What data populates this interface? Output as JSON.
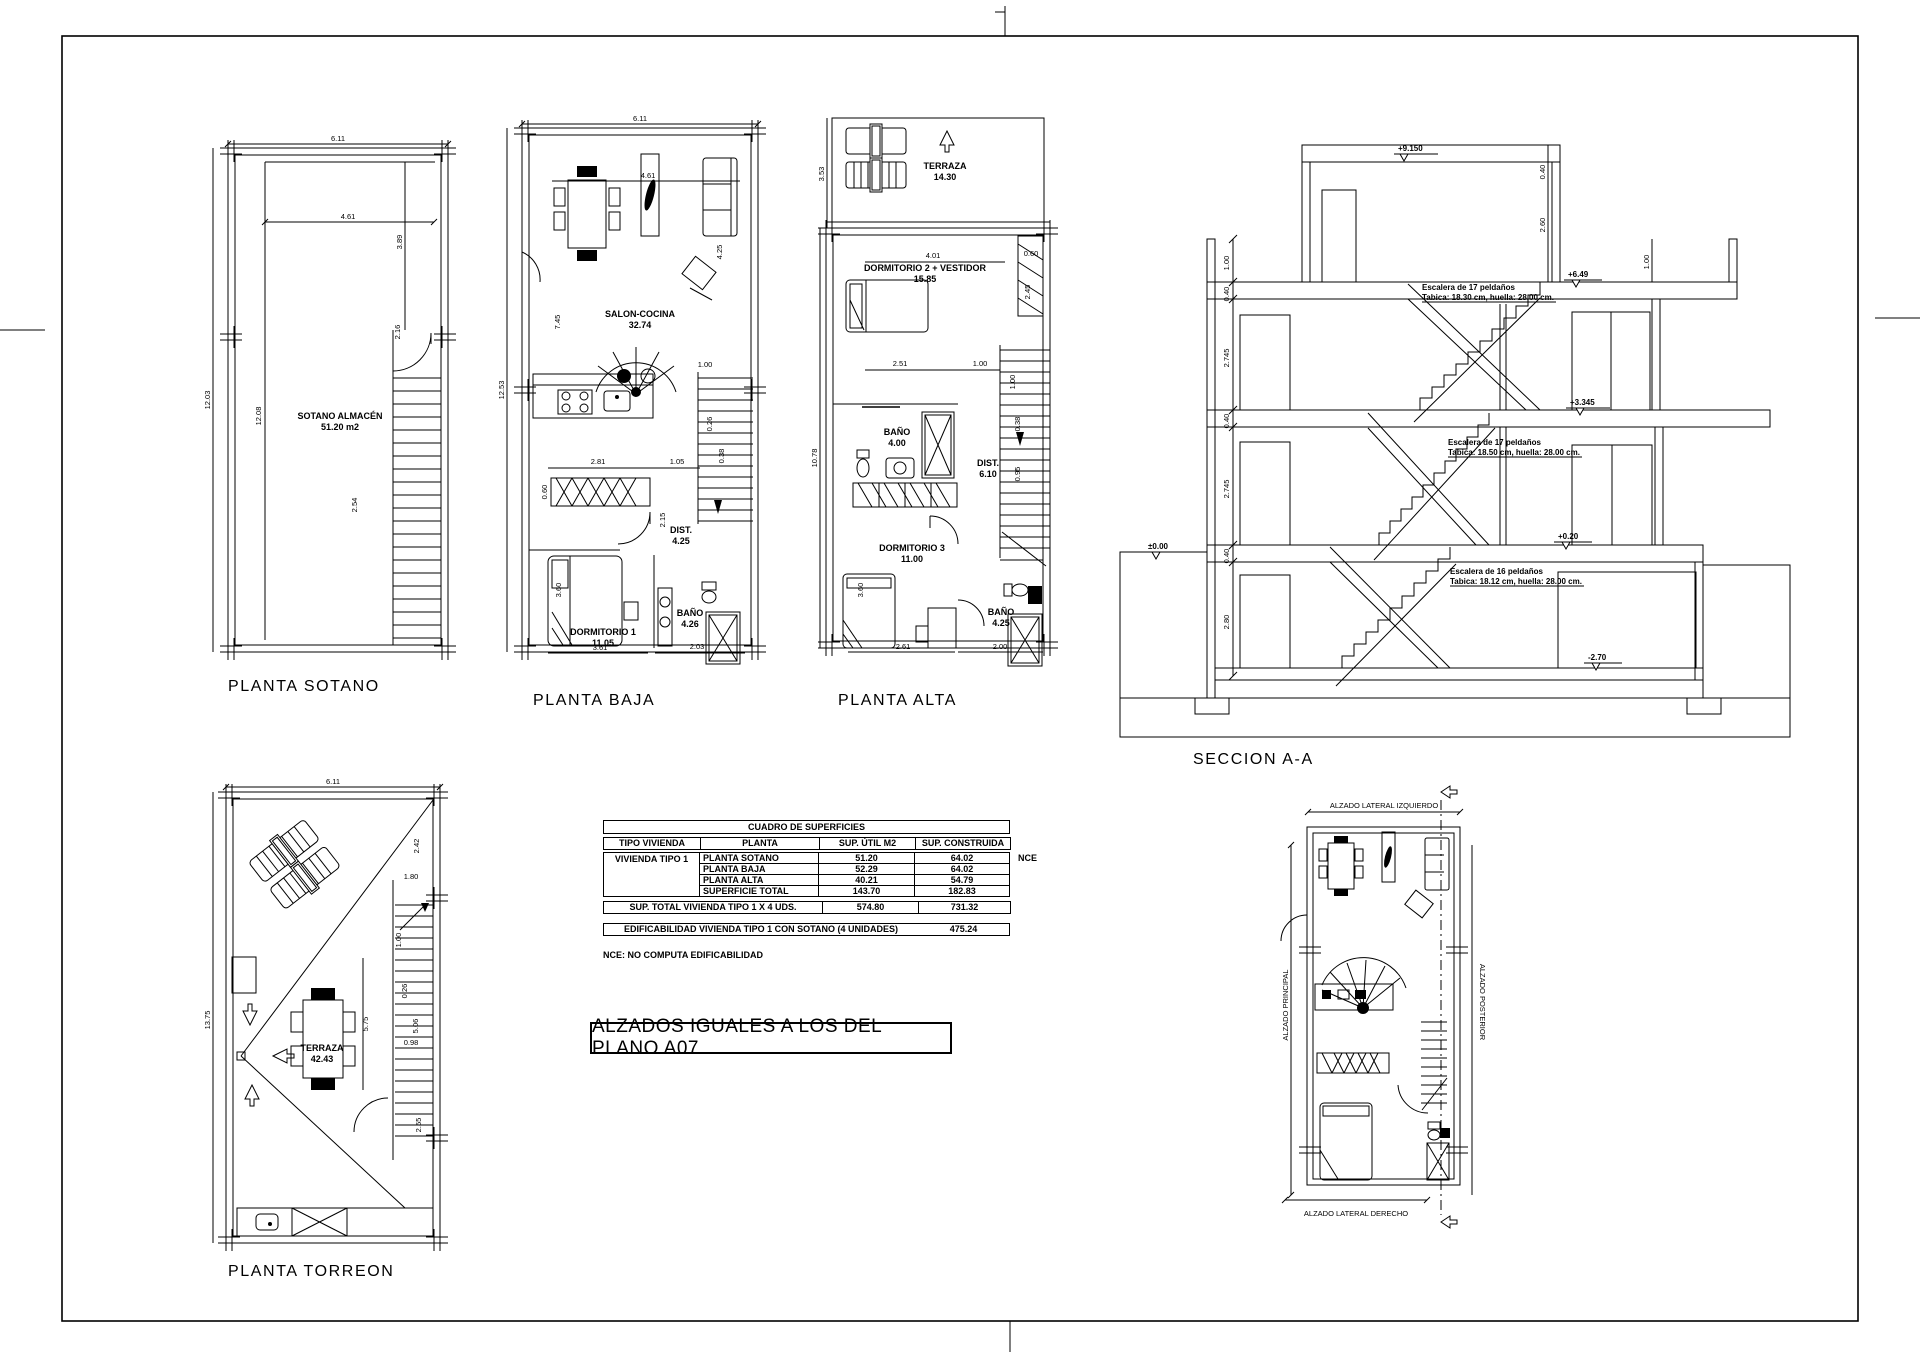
{
  "page": {
    "note_box": "ALZADOS IGUALES A LOS DEL PLANO A07",
    "footnote": "NCE:  NO COMPUTA EDIFICABILIDAD"
  },
  "plans": {
    "sotano": {
      "title": "PLANTA SOTANO",
      "room_name": "SOTANO ALMACÉN",
      "room_area": "51.20 m2",
      "dim_top": "6.11",
      "dim_inner_top": "4.61",
      "dim_left": "12.03",
      "dim_left2": "12.08",
      "dim_right": "3.89",
      "dim_stair": "2.16",
      "dim_bottom": "2.54"
    },
    "baja": {
      "title": "PLANTA BAJA",
      "salon_name": "SALON-COCINA",
      "salon_area": "32.74",
      "dist_name": "DIST.",
      "dist_area": "4.25",
      "dorm_name": "DORMITORIO 1",
      "dorm_area": "11.05",
      "bano_name": "BAÑO",
      "bano_area": "4.26",
      "dim_top": "6.11",
      "dim_inner_top": "4.61",
      "dim_left": "12.53",
      "dim_left2": "7.45",
      "dim_right": "4.25",
      "dim_k1": "2.81",
      "dim_k2": "1.05",
      "dim_k3": "2.15",
      "dim_k4": "0.60",
      "dim_s1": "1.00",
      "dim_s2": "0.26",
      "dim_s3": "0.38",
      "dim_b1": "3.61",
      "dim_b2": "2.03",
      "dim_b3": "3.60"
    },
    "alta": {
      "title": "PLANTA ALTA",
      "terraza_name": "TERRAZA",
      "terraza_area": "14.30",
      "dorm2_name": "DORMITORIO 2 + VESTIDOR",
      "dorm2_area": "15.85",
      "bano1_name": "BAÑO",
      "bano1_area": "4.00",
      "dist_name": "DIST.",
      "dist_area": "6.10",
      "dorm3_name": "DORMITORIO 3",
      "dorm3_area": "11.00",
      "bano2_name": "BAÑO",
      "bano2_area": "4.25",
      "dim_top": "4.01",
      "dim_left_top": "3.53",
      "dim_left": "10.78",
      "dim_r1": "0.60",
      "dim_r2": "2.45",
      "dim_m1": "2.51",
      "dim_m2": "1.00",
      "dim_m3": "1.00",
      "dim_st1": "0.38",
      "dim_st2": "0.95",
      "dim_b1": "2.61",
      "dim_b2": "2.00",
      "dim_b3": "3.60"
    },
    "torreon": {
      "title": "PLANTA TORREON",
      "terraza_name": "TERRAZA",
      "terraza_area": "42.43",
      "dim_top": "6.11",
      "dim_left": "13.75",
      "dim_r1": "2.42",
      "dim_r2": "1.80",
      "dim_r3": "1.00",
      "dim_r4": "0.26",
      "dim_r5": "5.06",
      "dim_r6": "0.98",
      "dim_m1": "5.75",
      "dim_b1": "2.55"
    },
    "seccion": {
      "title": "SECCION A-A",
      "stair_top_1": "Escalera de 17 peldaños",
      "stair_top_2": "Tabica: 18.30 cm, huella: 28.00 cm.",
      "stair_mid_1": "Escalera de 17 peldaños",
      "stair_mid_2": "Tabica: 18.50 cm, huella: 28.00 cm.",
      "stair_bot_1": "Escalera de 16 peldaños",
      "stair_bot_2": "Tabica: 18.12 cm, huella: 28.00 cm.",
      "lvl_top": "+9.150",
      "lvl_torreon": "+6.49",
      "lvl_first": "+3.345",
      "lvl_ground": "+0.20",
      "lvl_basement": "-2.70",
      "lvl_zero": "±0.00",
      "dim_l1": "1.00",
      "dim_l2": "0.40",
      "dim_l3": "2.745",
      "dim_l4": "0.40",
      "dim_l5": "2.745",
      "dim_l6": "0.40",
      "dim_l7": "2.80",
      "dim_r1": "0.40",
      "dim_r2": "2.60",
      "dim_r3": "1.00"
    }
  },
  "keyplan": {
    "label_top": "ALZADO LATERAL IZQUIERDO",
    "label_left": "ALZADO PRINCIPAL",
    "label_right": "ALZADO POSTERIOR",
    "label_bottom": "ALZADO LATERAL DERECHO"
  },
  "surfaces_table": {
    "title": "CUADRO DE SUPERFICIES",
    "col_tipo": "TIPO VIVIENDA",
    "col_planta": "PLANTA",
    "col_util": "SUP. ÚTIL M2",
    "col_constr": "SUP. CONSTRUIDA M2",
    "tipo": "VIVIENDA TIPO 1",
    "rows": [
      {
        "planta": "PLANTA SOTANO",
        "util": "51.20",
        "constr": "64.02",
        "note": "NCE"
      },
      {
        "planta": "PLANTA BAJA",
        "util": "52.29",
        "constr": "64.02",
        "note": ""
      },
      {
        "planta": "PLANTA ALTA",
        "util": "40.21",
        "constr": "54.79",
        "note": ""
      },
      {
        "planta": "SUPERFICIE TOTAL",
        "util": "143.70",
        "constr": "182.83",
        "note": ""
      }
    ],
    "total_label": "SUP. TOTAL VIVIENDA TIPO 1 X 4 UDS.",
    "total_util": "574.80",
    "total_constr": "731.32",
    "edif_label": "EDIFICABILIDAD VIVIENDA TIPO 1 CON SOTANO (4 UNIDADES)",
    "edif_value": "475.24"
  }
}
